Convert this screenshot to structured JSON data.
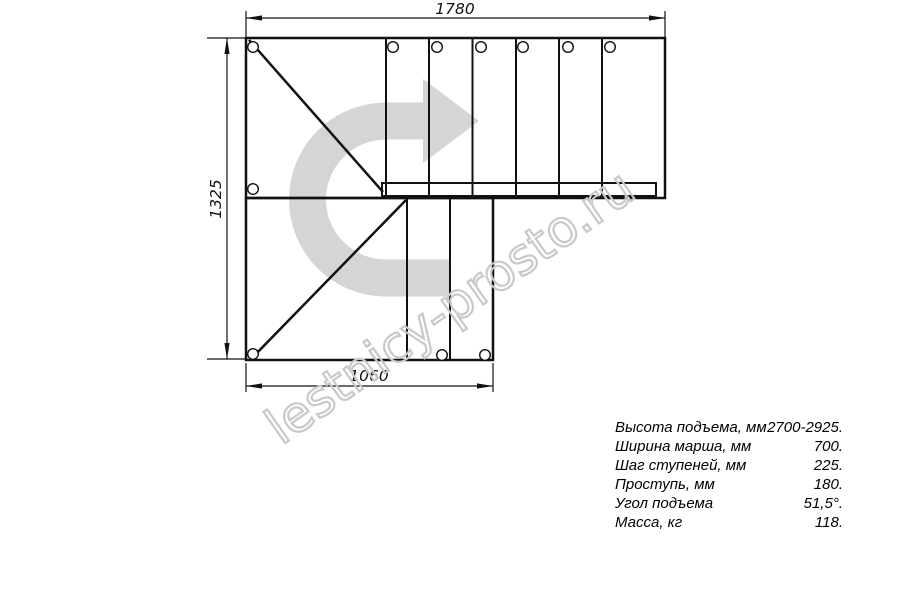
{
  "colors": {
    "line": "#111111",
    "arrow": "#d5d5d5",
    "watermark": "#c9c9c9"
  },
  "drawing": {
    "dim_top": "1780",
    "dim_left": "1325",
    "dim_bottom": "1060"
  },
  "watermark": {
    "text": "lestnicy-prosto.ru"
  },
  "specs": {
    "rows": [
      {
        "label": "Высота подъема, мм",
        "value": "2700-2925."
      },
      {
        "label": "Ширина марша, мм",
        "value": "700."
      },
      {
        "label": "Шаг ступеней, мм",
        "value": "225."
      },
      {
        "label": "Проступь, мм",
        "value": "180."
      },
      {
        "label": "Угол подъема",
        "value": "51,5°."
      },
      {
        "label": "Масса, кг",
        "value": "118."
      }
    ]
  }
}
